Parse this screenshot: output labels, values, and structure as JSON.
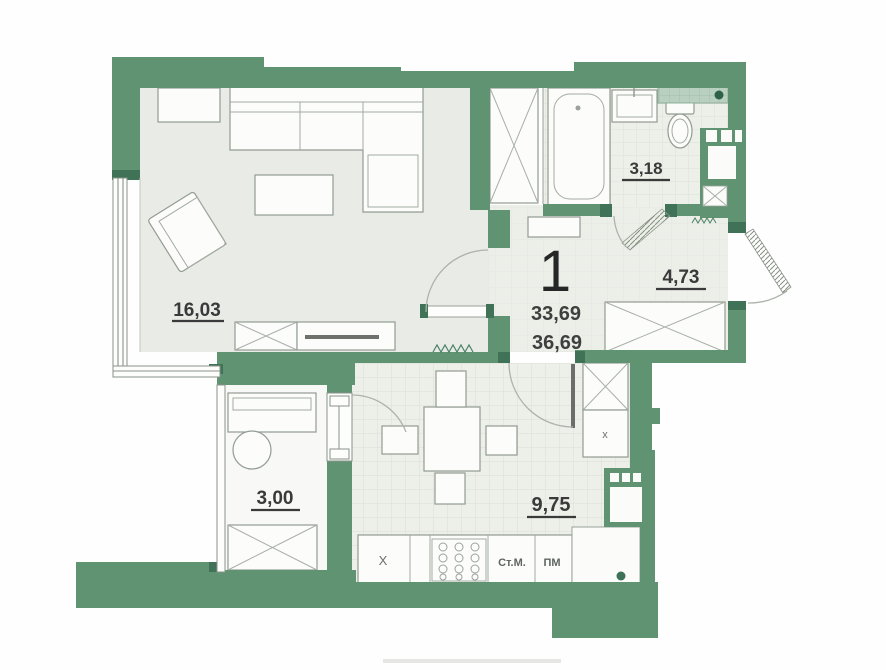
{
  "plan": {
    "unit_number": "1",
    "area_living": "33,69",
    "area_total": "36,69",
    "rooms": {
      "living": "16,03",
      "bathroom": "3,18",
      "hallway": "4,73",
      "balcony": "3,00",
      "kitchen": "9,75"
    },
    "appliance_labels": {
      "washing_machine": "Ст.М.",
      "dishwasher": "ПМ",
      "sink_mark": "X",
      "cabinet_mark": "x"
    },
    "colors": {
      "wall_green": "#5f9371",
      "wall_dark_green": "#3f7257",
      "floor_light": "#e8ebe6",
      "floor_tile": "#edefe9",
      "balcony_floor": "#f8f9f6",
      "label_text": "#3a3a3a"
    }
  }
}
